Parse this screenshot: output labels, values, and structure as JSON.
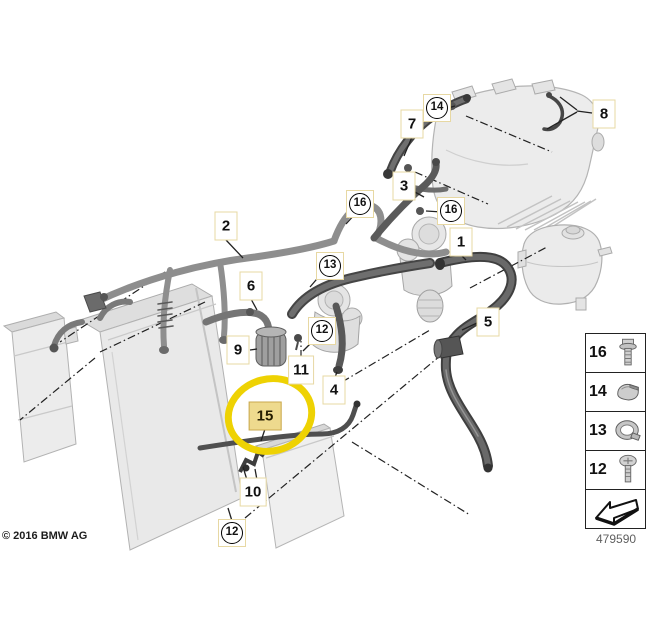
{
  "footer": {
    "copyright": "© 2016 BMW AG",
    "diagram_number": "479590"
  },
  "highlight": {
    "part": "15",
    "ellipse_color": "#eed203",
    "box_fill": "#eeda8e"
  },
  "colors": {
    "callout_border": "#e7d8a3",
    "hose_light": "#8e8e8e",
    "hose_dark": "#5a5a5a"
  },
  "callouts": [
    {
      "name": "callout-2",
      "num": "2",
      "type": "box",
      "x": 226,
      "y": 226
    },
    {
      "name": "callout-6",
      "num": "6",
      "type": "box",
      "x": 251,
      "y": 286
    },
    {
      "name": "callout-9",
      "num": "9",
      "type": "box",
      "x": 238,
      "y": 350
    },
    {
      "name": "callout-11",
      "num": "11",
      "type": "box",
      "x": 301,
      "y": 370
    },
    {
      "name": "callout-4",
      "num": "4",
      "type": "box",
      "x": 334,
      "y": 390
    },
    {
      "name": "callout-15",
      "num": "15",
      "type": "highlight",
      "x": 265,
      "y": 416
    },
    {
      "name": "callout-10",
      "num": "10",
      "type": "box",
      "x": 253,
      "y": 492
    },
    {
      "name": "callout-12-bottom",
      "num": "12",
      "type": "circle",
      "x": 232,
      "y": 533
    },
    {
      "name": "callout-13",
      "num": "13",
      "type": "circle",
      "x": 330,
      "y": 266
    },
    {
      "name": "callout-12-middle",
      "num": "12",
      "type": "circle",
      "x": 322,
      "y": 331
    },
    {
      "name": "callout-16-left",
      "num": "16",
      "type": "circle",
      "x": 360,
      "y": 204
    },
    {
      "name": "callout-16-right",
      "num": "16",
      "type": "circle",
      "x": 451,
      "y": 211
    },
    {
      "name": "callout-3",
      "num": "3",
      "type": "box",
      "x": 404,
      "y": 186
    },
    {
      "name": "callout-7",
      "num": "7",
      "type": "box",
      "x": 412,
      "y": 124
    },
    {
      "name": "callout-14",
      "num": "14",
      "type": "circle",
      "x": 437,
      "y": 108
    },
    {
      "name": "callout-8",
      "num": "8",
      "type": "box",
      "x": 604,
      "y": 114
    },
    {
      "name": "callout-1",
      "num": "1",
      "type": "box",
      "x": 461,
      "y": 242
    },
    {
      "name": "callout-5",
      "num": "5",
      "type": "box",
      "x": 488,
      "y": 322
    }
  ],
  "legend": {
    "rows": [
      {
        "label": "16",
        "icon": "flange-bolt-icon"
      },
      {
        "label": "14",
        "icon": "retaining-clip-icon"
      },
      {
        "label": "13",
        "icon": "hose-clamp-icon"
      },
      {
        "label": "12",
        "icon": "pan-screw-icon"
      },
      {
        "label": "",
        "icon": "direction-arrow-icon"
      }
    ]
  }
}
